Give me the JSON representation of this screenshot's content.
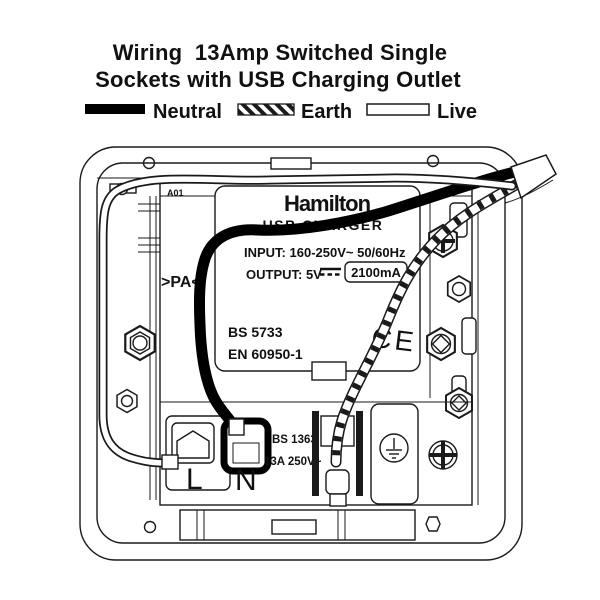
{
  "title": {
    "line1": "Wiring  13Amp Switched Single",
    "line2": "Sockets with USB Charging Outlet"
  },
  "legend": {
    "items": [
      {
        "label": "Neutral",
        "swatch": "solid-black"
      },
      {
        "label": "Earth",
        "swatch": "diagonal-hatched"
      },
      {
        "label": "Live",
        "swatch": "white-outline"
      }
    ]
  },
  "diagram": {
    "brand": "Hamilton",
    "product": "USB CHARGER",
    "input_line": "INPUT: 160-250V~ 50/60Hz",
    "output_prefix": "OUTPUT: 5V",
    "output_value": "2100mA",
    "standard_1": "BS 5733",
    "standard_2": "EN 60950-1",
    "ce_mark": "CE",
    "marking_a01": "A01",
    "marking_pa": ">PA<",
    "socket_standard": "BS 1363",
    "socket_rating": "13A 250V~",
    "terminal_live": "L",
    "terminal_neutral": "N"
  },
  "colors": {
    "line": "#1a1a1a",
    "background": "#ffffff",
    "neutral_wire": "#000000",
    "live_wire": "#ffffff"
  }
}
